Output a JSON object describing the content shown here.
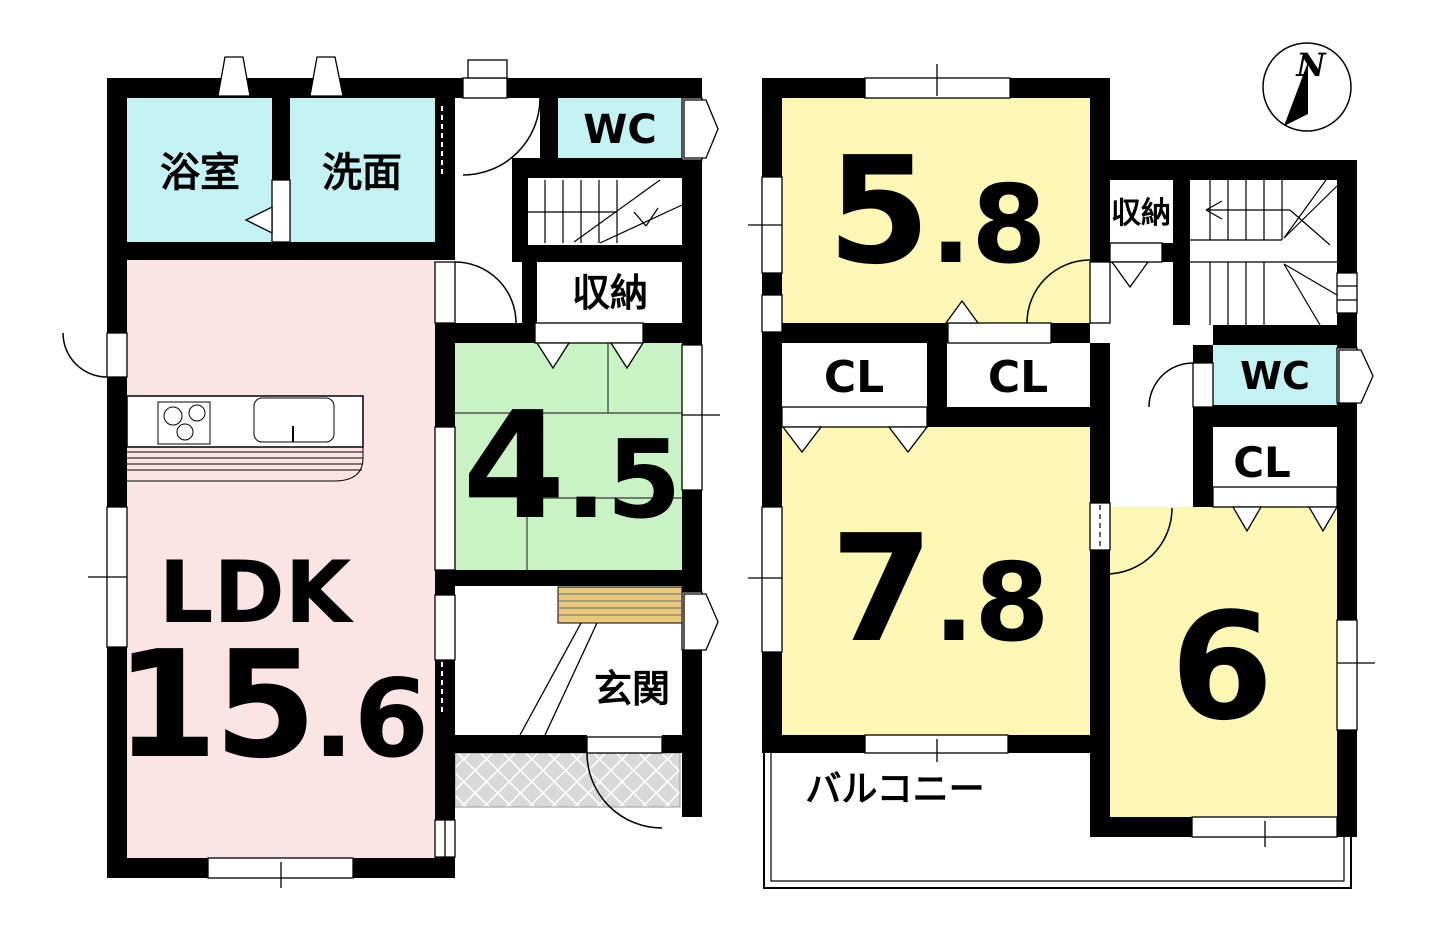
{
  "colors": {
    "wall": "#000000",
    "wet_room": "#c4f1f2",
    "ldk_pink": "#fbe5e4",
    "tatami_green": "#c9f2c5",
    "bedroom_yellow": "#fcf7b4",
    "cabinet_tan": "#e9c87f",
    "porch_gray": "#d9d9d9"
  },
  "floor1": {
    "bath": "浴室",
    "washroom": "洗面",
    "wc": "WC",
    "storage": "収納",
    "tatami_main": "4",
    "tatami_sub": ".5",
    "ldk_label": "LDK",
    "ldk_main": "15",
    "ldk_sub": ".6",
    "entrance": "玄関"
  },
  "floor2": {
    "room58_main": "5",
    "room58_sub": ".8",
    "storage": "収納",
    "cl_a": "CL",
    "cl_b": "CL",
    "wc": "WC",
    "cl_c": "CL",
    "room78_main": "7",
    "room78_sub": ".8",
    "room6": "6",
    "balcony": "バルコニー"
  },
  "compass": {
    "north": "N"
  }
}
